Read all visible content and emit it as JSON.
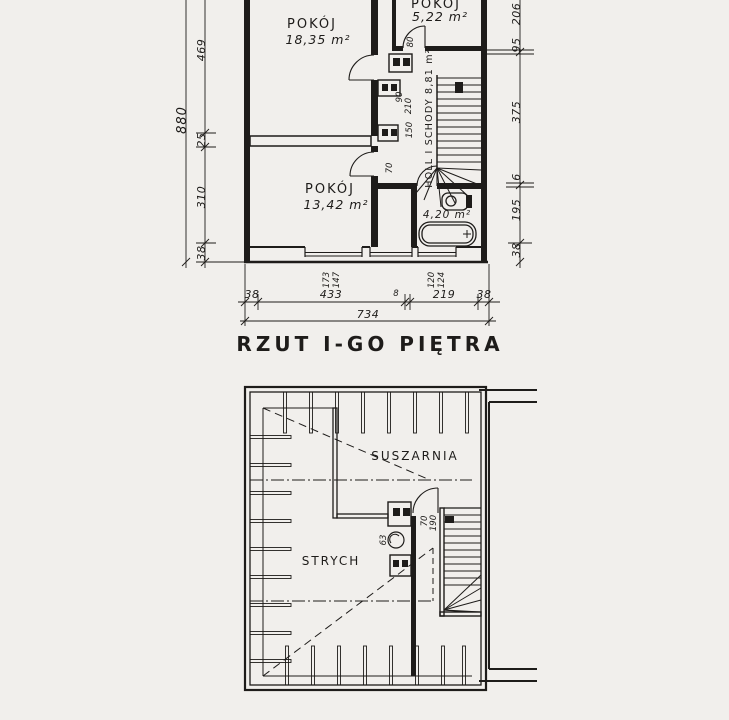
{
  "document": {
    "background": "#f1efec",
    "ink": "#1e1c1a"
  },
  "title": "RZUT I-GO PIĘTRA",
  "upper_plan": {
    "rooms": {
      "pokoj_large": {
        "label": "POKÓJ",
        "area": "18,35 m²"
      },
      "pokoj_small": {
        "label": "POKÓJ",
        "area": "5,22 m²"
      },
      "pokoj_medium": {
        "label": "POKÓJ",
        "area": "13,42 m²"
      },
      "hall_stairs": {
        "label": "HOLL I SCHODY 8,81 m²"
      },
      "bathroom": {
        "area": "4,20 m²"
      }
    },
    "dimensions": {
      "left_total": "880",
      "left_segments": [
        "469",
        "25",
        "310",
        "38"
      ],
      "right_segments": [
        "206",
        "95",
        "375",
        "6",
        "195",
        "38"
      ],
      "bottom_segments": [
        "38",
        "433",
        "8",
        "219",
        "38"
      ],
      "bottom_total": "734",
      "window_1": [
        "173",
        "147"
      ],
      "window_2": [
        "120",
        "124"
      ],
      "door_marks": [
        "80",
        "90",
        "210",
        "150",
        "70"
      ]
    }
  },
  "attic_plan": {
    "rooms": {
      "suszarnia": {
        "label": "SUSZARNIA"
      },
      "strych": {
        "label": "STRYCH"
      }
    },
    "door_mark": [
      "70",
      "190"
    ],
    "flue_mark": "63"
  }
}
